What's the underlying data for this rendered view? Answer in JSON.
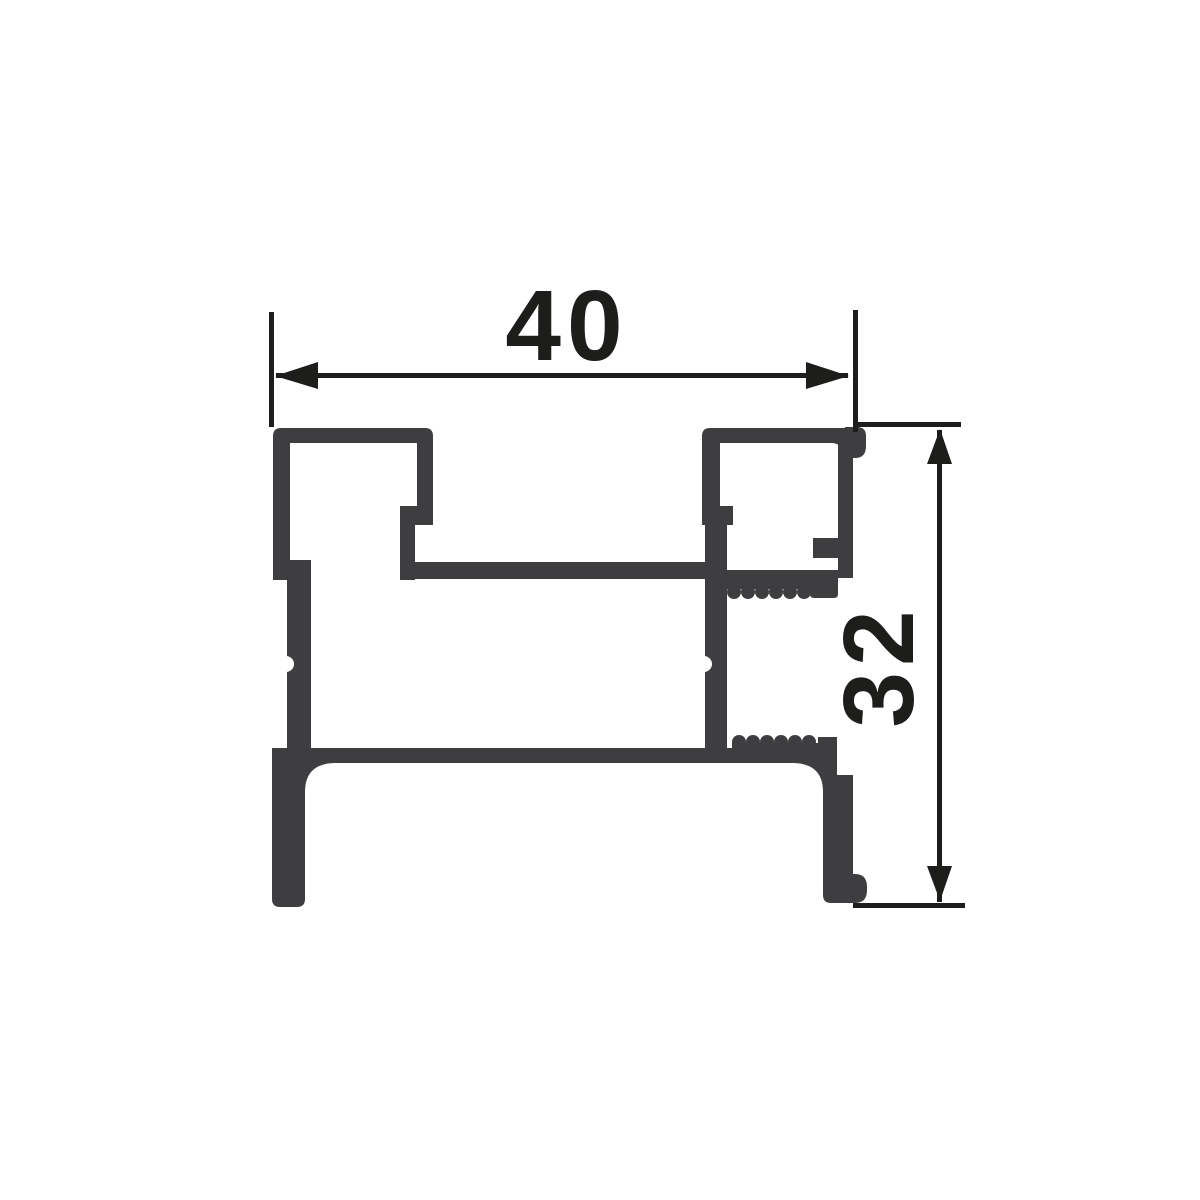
{
  "drawing": {
    "kind": "profile-cross-section",
    "dimensions": {
      "width": {
        "label": "40"
      },
      "height": {
        "label": "32"
      }
    }
  },
  "colors": {
    "background": "#ffffff",
    "profile": "#3e3e40",
    "dimension": "#1d1d1b"
  }
}
